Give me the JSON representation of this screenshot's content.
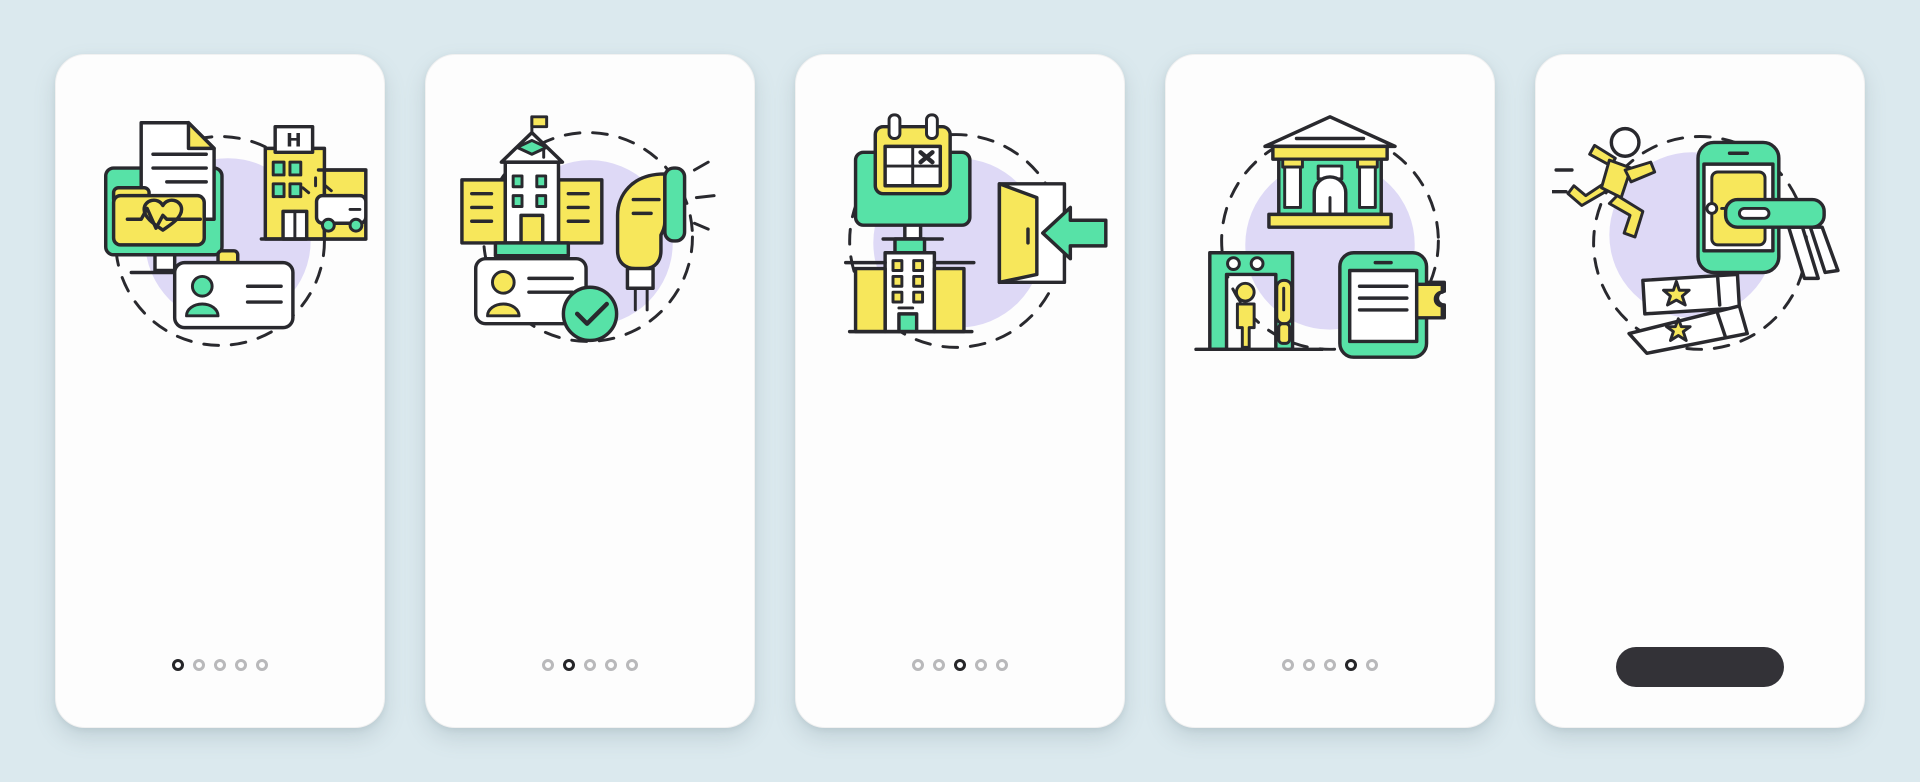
{
  "canvas": {
    "width": 1920,
    "height": 782,
    "background": "#dbe9ee"
  },
  "palette": {
    "green": "#57e2a7",
    "yellow": "#f7e75b",
    "lavender": "#ded9f6",
    "outline": "#29292e",
    "page_bg": "#dbe9ee",
    "card_bg": "#fdfdfd",
    "dot_active": "#262629",
    "dot_inactive": "#b9b9bb",
    "button_bg": "#333237"
  },
  "screens": [
    {
      "id": "screen-1",
      "concept": "medical-records",
      "icons": [
        "monitor-icon",
        "document-icon",
        "health-folder-heart-icon",
        "hospital-building-icon",
        "ambulance-icon",
        "id-badge-icon",
        "dashed-circle",
        "lavender-blob"
      ],
      "hospital_sign": "H",
      "pagination": {
        "dots": 5,
        "active_index": 0
      }
    },
    {
      "id": "screen-2",
      "concept": "student-id-verification",
      "icons": [
        "school-building-icon",
        "graduation-cap-icon",
        "flag-icon",
        "barcode-scanner-icon",
        "id-card-icon",
        "check-circle-icon",
        "dashed-circle",
        "lavender-blob"
      ],
      "pagination": {
        "dots": 5,
        "active_index": 1
      }
    },
    {
      "id": "screen-3",
      "concept": "booking-cancellation-exit",
      "icons": [
        "monitor-icon",
        "calendar-cancel-icon",
        "office-building-icon",
        "open-door-icon",
        "arrow-left-icon",
        "dashed-circle",
        "lavender-blob"
      ],
      "pagination": {
        "dots": 5,
        "active_index": 2
      }
    },
    {
      "id": "screen-4",
      "concept": "museum-security-entry",
      "icons": [
        "museum-building-icon",
        "metal-detector-gate-icon",
        "visitor-person-icon",
        "security-wand-icon",
        "smartphone-ticket-icon",
        "dashed-circle",
        "lavender-blob"
      ],
      "pagination": {
        "dots": 5,
        "active_index": 3
      }
    },
    {
      "id": "screen-5",
      "concept": "skip-the-line-ticket",
      "icons": [
        "running-person-icon",
        "arrow-right-icon",
        "smartphone-ticket-icon",
        "ticket-scanner-icon",
        "torn-tickets-star-icon",
        "dashed-circle",
        "lavender-blob"
      ],
      "cta_button": {
        "label": "",
        "style": "dark-pill"
      }
    }
  ]
}
